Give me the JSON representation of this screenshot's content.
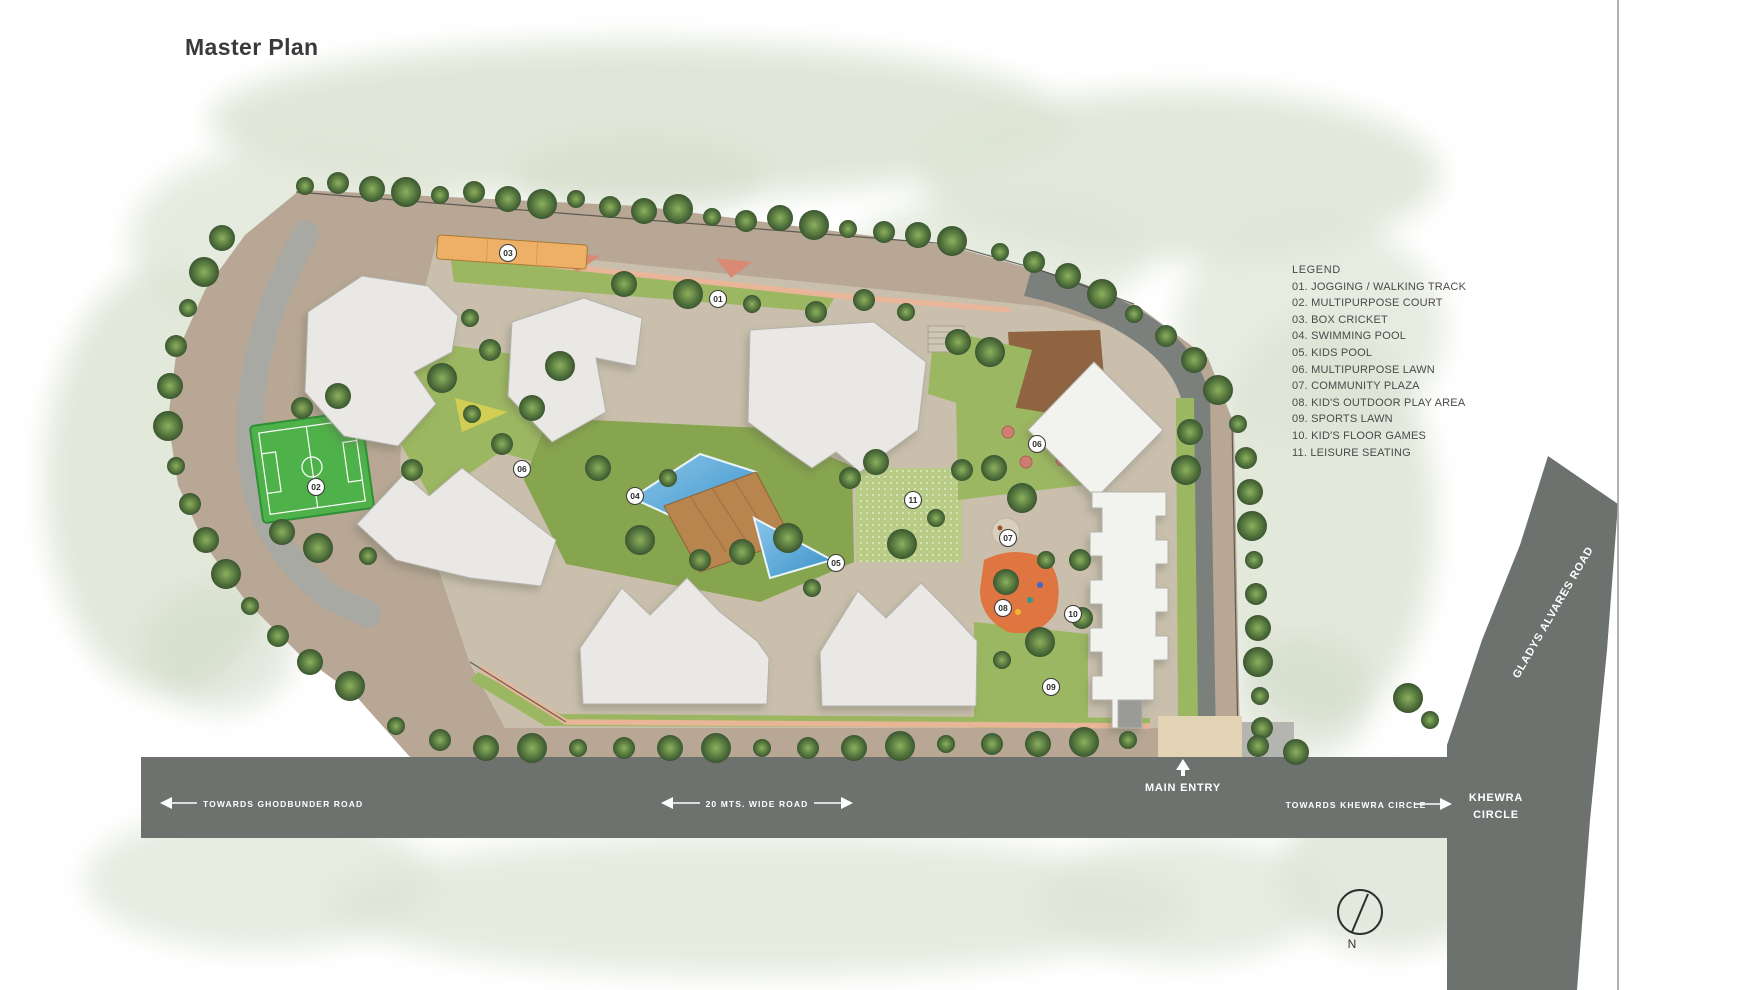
{
  "title": "Master Plan",
  "legend": {
    "title": "LEGEND",
    "items": [
      "01. JOGGING / WALKING TRACK",
      "02. MULTIPURPOSE COURT",
      "03. BOX CRICKET",
      "04. SWIMMING POOL",
      "05. KIDS POOL",
      "06. MULTIPURPOSE LAWN",
      "07. COMMUNITY PLAZA",
      "08. KID'S OUTDOOR PLAY AREA",
      "09. SPORTS LAWN",
      "10. KID'S FLOOR GAMES",
      "11. LEISURE SEATING"
    ]
  },
  "roads": {
    "ghodbunder": "TOWARDS GHODBUNDER ROAD",
    "wide_road": "20 MTS. WIDE ROAD",
    "main_entry": "MAIN ENTRY",
    "towards_khewra": "TOWARDS KHEWRA CIRCLE",
    "khewra_line1": "KHEWRA",
    "khewra_line2": "CIRCLE",
    "gladys": "GLADYS ALVARES ROAD"
  },
  "compass": {
    "label": "N"
  },
  "markers": [
    {
      "num": "01",
      "x": 718,
      "y": 299
    },
    {
      "num": "02",
      "x": 316,
      "y": 487
    },
    {
      "num": "03",
      "x": 508,
      "y": 253
    },
    {
      "num": "04",
      "x": 635,
      "y": 496
    },
    {
      "num": "05",
      "x": 836,
      "y": 563
    },
    {
      "num": "06",
      "x": 522,
      "y": 469
    },
    {
      "num": "06",
      "x": 1037,
      "y": 444
    },
    {
      "num": "07",
      "x": 1008,
      "y": 538
    },
    {
      "num": "08",
      "x": 1003,
      "y": 608
    },
    {
      "num": "09",
      "x": 1051,
      "y": 687
    },
    {
      "num": "10",
      "x": 1073,
      "y": 614
    },
    {
      "num": "11",
      "x": 913,
      "y": 500
    }
  ],
  "colors": {
    "road": "#6d726f",
    "road2": "#7b807d",
    "apron": "#b7a794",
    "pavement": "#c9bfac",
    "lawn": "#9cb761",
    "lawn-dark": "#87a54e",
    "lawn-light": "#b9cc86",
    "track": "#ecb59a",
    "pool": "#5aa7d6",
    "deck": "#b8854f",
    "court": "#4fb149",
    "cricket": "#eeb066",
    "playground": "#e0713a",
    "building": "#e9e8e4",
    "building-edge": "#b3b2ac",
    "wash": "#dde4d4"
  }
}
